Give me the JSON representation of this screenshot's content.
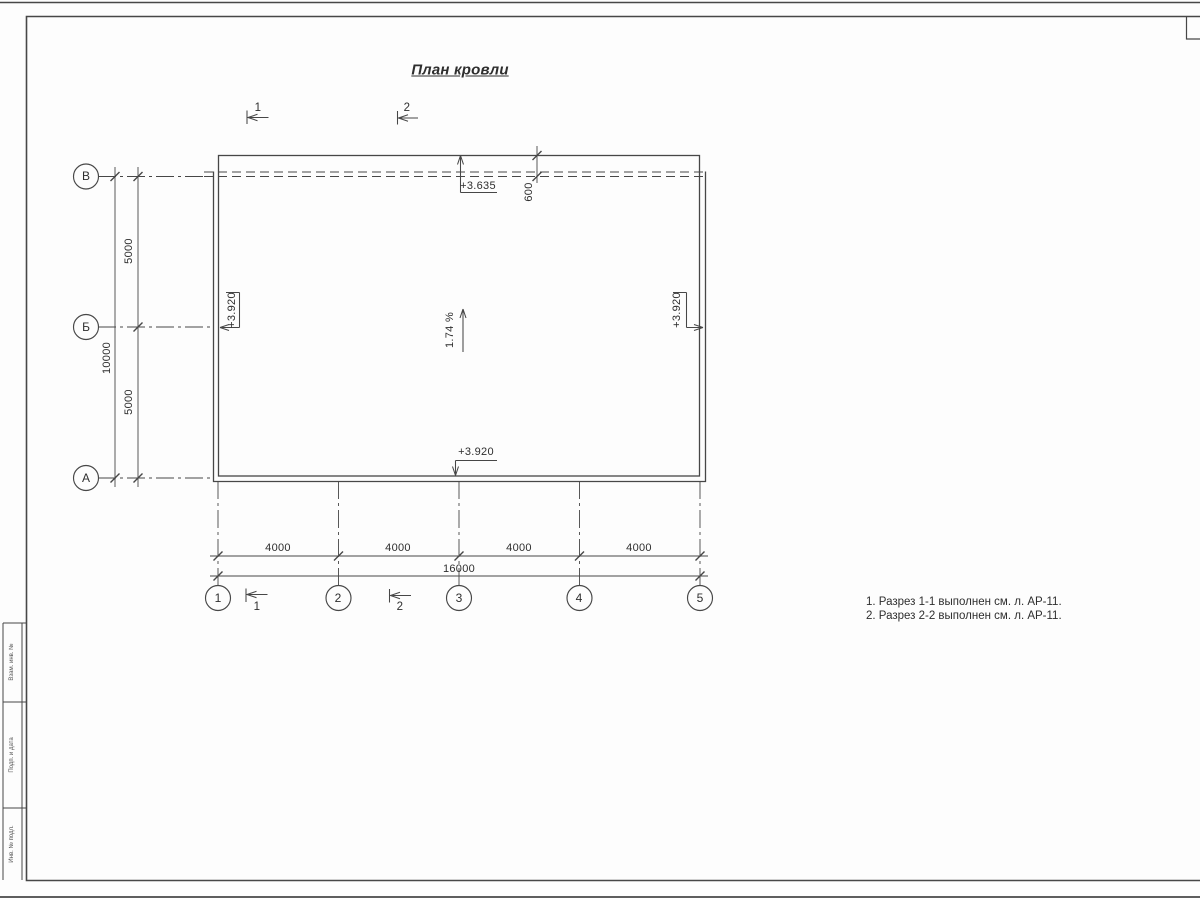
{
  "sheet": {
    "title": "План кровли",
    "notes": [
      "1. Разрез 1-1 выполнен см. л. АР-11.",
      "2. Разрез 2-2 выполнен см. л. АР-11."
    ],
    "stamp_side_labels": [
      "Взам. инв. №",
      "Подп. и дата",
      "Инв. № подл."
    ]
  },
  "plan": {
    "axes": {
      "columns": [
        "1",
        "2",
        "3",
        "4",
        "5"
      ],
      "rows": [
        "В",
        "Б",
        "А"
      ]
    },
    "dimensions": {
      "column_spacing": [
        "4000",
        "4000",
        "4000",
        "4000"
      ],
      "column_total": "16000",
      "row_spacing": [
        "5000",
        "5000"
      ],
      "row_total": "10000",
      "roof_overhang": "600"
    },
    "elevations": {
      "top": "+3.635",
      "left": "+3.920",
      "right": "+3.920",
      "bottom": "+3.920"
    },
    "slope": "1.74 %",
    "section_marks": {
      "top": [
        "1",
        "2"
      ],
      "bottom": [
        "1",
        "2"
      ]
    },
    "colors": {
      "line": "#474747",
      "text": "#2e2e2e",
      "background": "#fdfdfd"
    }
  }
}
